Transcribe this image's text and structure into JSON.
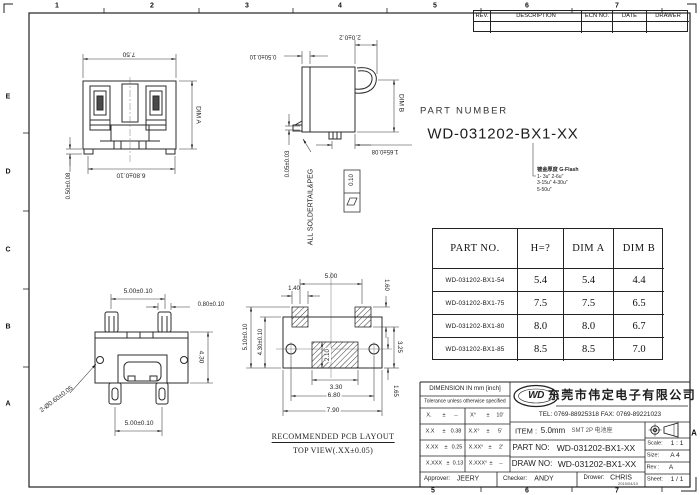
{
  "colors": {
    "line": "#2b2b2b",
    "text": "#1d1d1d"
  },
  "sheet": {
    "zones_top": [
      "1",
      "2",
      "3",
      "4",
      "5",
      "6",
      "7"
    ],
    "zones_bottom": [
      "5",
      "6",
      "7"
    ],
    "zones_left": [
      "E",
      "D",
      "C",
      "B",
      "A"
    ],
    "zone_marker_right": "A"
  },
  "rev_table": {
    "headers": [
      "REV.",
      "DESCRIPTION",
      "ECN NO.",
      "DATE",
      "DRAWER"
    ]
  },
  "part_number": {
    "label": "PART NUMBER",
    "value": "WD-031202-BX1-XX",
    "plating_note_title": "镀金厚度 G-Flash",
    "plating_note_lines": [
      "1- 3u\"  2-6u\"",
      "3-15u\" 4-30u\"",
      "5-50u\""
    ]
  },
  "spec_table": {
    "headers": {
      "part": "PART NO.",
      "h": "H=?",
      "a": "DIM A",
      "b": "DIM B"
    },
    "rows": [
      {
        "part": "WD-031202-BX1-54",
        "h": "5.4",
        "a": "5.4",
        "b": "4.4"
      },
      {
        "part": "WD-031202-BX1-75",
        "h": "7.5",
        "a": "7.5",
        "b": "6.5"
      },
      {
        "part": "WD-031202-BX1-80",
        "h": "8.0",
        "a": "8.0",
        "b": "6.7"
      },
      {
        "part": "WD-031202-BX1-85",
        "h": "8.5",
        "a": "8.5",
        "b": "7.0"
      }
    ]
  },
  "views": {
    "front": {
      "dim_width_top": "7.50",
      "dim_height_right": "DIM A",
      "dim_width_bottom": "6.80±0.10",
      "dim_foot_left": "0.50±0.08"
    },
    "side": {
      "dim_top": "2.0±0.2",
      "dim_top_left": "0.50±0.10",
      "dim_height_right": "DIM B",
      "dim_bottom": "1.65±0.08",
      "dim_left": "0.05±0.03",
      "note": "ALL SOLDERTAIL&PEG",
      "flatness": "0.10"
    },
    "top": {
      "dim_pegs_top": "5.00±0.10",
      "dim_peg_width": "0.80±0.10",
      "dim_height_right": "4.30",
      "dim_holes": "2-Ø0.60±0.05",
      "dim_pegs_bottom": "5.00±0.10"
    },
    "pcb": {
      "dim_pads_pitch": "5.00",
      "dim_pad_width": "1.40",
      "dim_pad_height": "1.60",
      "dim_left_outer": "5.10±0.10",
      "dim_left_inner": "4.30±0.10",
      "dim_right_upper": "3.25",
      "dim_center_pad": "2.10",
      "dim_bottom_inner": "3.30",
      "dim_bottom_mid": "6.80",
      "dim_bottom_outer": "7.90",
      "dim_right_lower": "1.65",
      "caption_line1": "RECOMMENDED PCB LAYOUT",
      "caption_line2": "TOP VIEW(.XX±0.05)"
    }
  },
  "title_block": {
    "dimension_header": "DIMENSION IN mm [inch]",
    "tolerance_note": "Tolerance unless otherwise specified",
    "tolerances": [
      {
        "c1": "X.",
        "s1": "±",
        "v1": "--",
        "c2": "X°",
        "s2": "±",
        "v2": "10'"
      },
      {
        "c1": "X.X",
        "s1": "±",
        "v1": "0.38",
        "c2": "X.X°",
        "s2": "±",
        "v2": "5'"
      },
      {
        "c1": "X.XX",
        "s1": "±",
        "v1": "0.25",
        "c2": "X.XX°",
        "s2": "±",
        "v2": "2'"
      },
      {
        "c1": "X.XXX",
        "s1": "±",
        "v1": "0.13",
        "c2": "X.XXX°",
        "s2": "±",
        "v2": "--"
      }
    ],
    "approver_label": "Approver:",
    "approver": "JEERY",
    "checker_label": "Checker:",
    "checker": "ANDY",
    "drawer_label": "Drower:",
    "drawer": "CHRIS",
    "drawer_date": "2015/04/10",
    "logo_text": "WD",
    "company": "东莞市伟定电子有限公司",
    "tel": "TEL: 0769-88925318  FAX: 0769-89221023",
    "item_label": "ITEM :",
    "item_value": "5.0mm",
    "item_desc": "SMT 2P 电池座",
    "part_no_label": "PART  NO:",
    "part_no": "WD-031202-BX1-XX",
    "draw_no_label": "DRAW  NO:",
    "draw_no": "WD-031202-BX1-XX",
    "scale_label": "Scale:",
    "scale": "1 : 1",
    "size_label": "Size:",
    "size": "A 4",
    "rev_label": "Rev :",
    "rev": "A",
    "sheet_label": "Sheet:",
    "sheet": "1 / 1"
  }
}
